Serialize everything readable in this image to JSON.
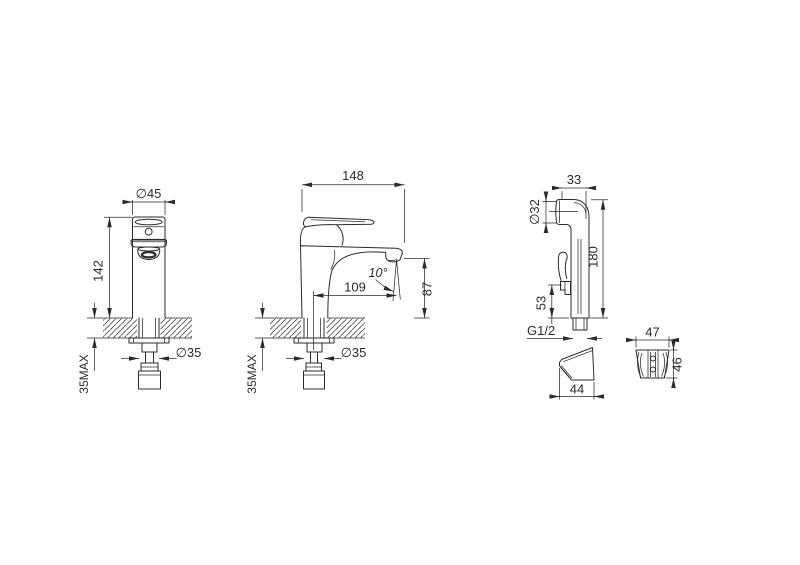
{
  "colors": {
    "background": "#ffffff",
    "line": "#2b2b2b"
  },
  "views": {
    "front": {
      "dims": {
        "top_dia": "∅45",
        "height": "142",
        "deck_max": "35MAX",
        "hole_dia": "∅35"
      }
    },
    "side": {
      "dims": {
        "width": "148",
        "angle": "10°",
        "reach": "109",
        "spout_h": "87",
        "deck_max": "35MAX",
        "hole_dia": "∅35"
      }
    },
    "sprayer": {
      "dims": {
        "head_w": "33",
        "head_dia": "∅32",
        "height": "180",
        "lever_h": "53",
        "thread": "G1/2"
      }
    },
    "bracket_side": {
      "dims": {
        "depth": "44"
      }
    },
    "bracket_front": {
      "dims": {
        "width": "47",
        "height": "46"
      }
    }
  }
}
